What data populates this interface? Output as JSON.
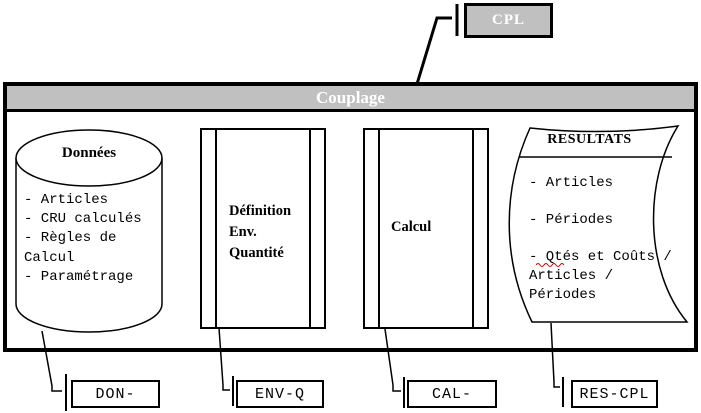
{
  "colors": {
    "panel_gray": "#c0c0c0",
    "header_text": "#ffffff",
    "line": "#000000",
    "spellcheck_red": "#cc0000"
  },
  "cpl_tab": {
    "label": "CPL"
  },
  "couplage": {
    "title": "Couplage"
  },
  "donnees": {
    "title": "Données",
    "lines": [
      "- Articles",
      "- CRU calculés",
      "- Règles de",
      "Calcul",
      "- Paramétrage"
    ]
  },
  "definition": {
    "lines": [
      "Définition",
      "Env.",
      "Quantité"
    ]
  },
  "calcul": {
    "label": "Calcul"
  },
  "resultats": {
    "title": "RESULTATS",
    "lines": [
      "- Articles",
      "",
      "- Périodes",
      "",
      "- Qtés et Coûts /",
      "Articles /",
      "Périodes"
    ]
  },
  "files": {
    "don": "DON-",
    "env": "ENV-Q",
    "cal": "CAL-",
    "res": "RES-CPL"
  }
}
